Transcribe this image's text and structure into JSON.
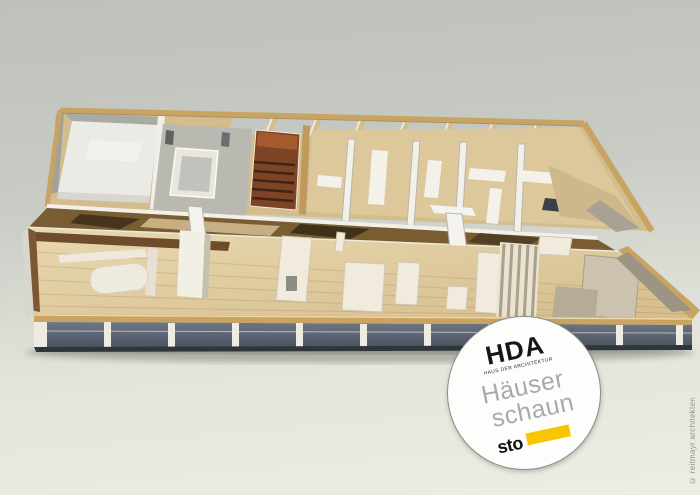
{
  "scene": {
    "colors": {
      "bg_top": "#bdc1b9",
      "bg_bottom": "#eceee4",
      "wood_frame": "#c9a361",
      "balsa_floor": "#e0cb9e",
      "white_walls": "#f1efe8",
      "glazing": "#5d6773",
      "dark_wood": "#7c4425"
    }
  },
  "badge": {
    "org": "HDA",
    "org_subtitle": "HAUS DER ARCHITEKTUR",
    "title_line1": "Häuser",
    "title_line2": "schaun",
    "brand": "sto",
    "accent_color": "#F7C600"
  },
  "watermark": {
    "credit": "© reitmayr architekten"
  }
}
